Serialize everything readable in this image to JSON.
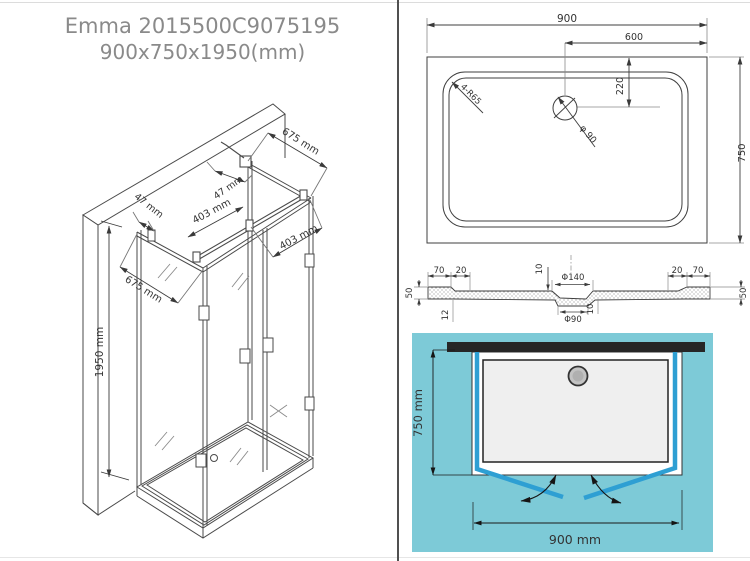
{
  "title": {
    "line1": "Emma 2015500C9075195",
    "line2": "900x750x1950(mm)"
  },
  "iso_view": {
    "dim_height": "1950 mm",
    "dim_depth_top": "675 mm",
    "dim_depth_bottom": "675 mm",
    "dim_gap_top": "47 mm",
    "dim_gap_left": "47 mm",
    "dim_door_left": "403 mm",
    "dim_door_right": "403 mm"
  },
  "plan_view": {
    "dim_width": "900",
    "dim_drain_offset": "600",
    "dim_drain_depth": "220",
    "dim_depth": "750",
    "corner_radius_label": "4-R65",
    "drain_diameter_label": "φ 90"
  },
  "section_view": {
    "left_lip": "70",
    "left_step": "20",
    "left_height": "50",
    "left_thickness": "12",
    "recess_depth_top": "10",
    "recess_top_diameter": "Φ140",
    "recess_bottom_diameter": "Φ90",
    "recess_depth_bottom": "10",
    "right_step": "20",
    "right_lip": "70",
    "right_height": "50"
  },
  "install_view": {
    "dim_depth": "750 mm",
    "dim_width": "900 mm"
  },
  "colors": {
    "background_cyan": "#7dcad7",
    "panel_blue": "#2e9fd3",
    "wall_black": "#262626"
  }
}
